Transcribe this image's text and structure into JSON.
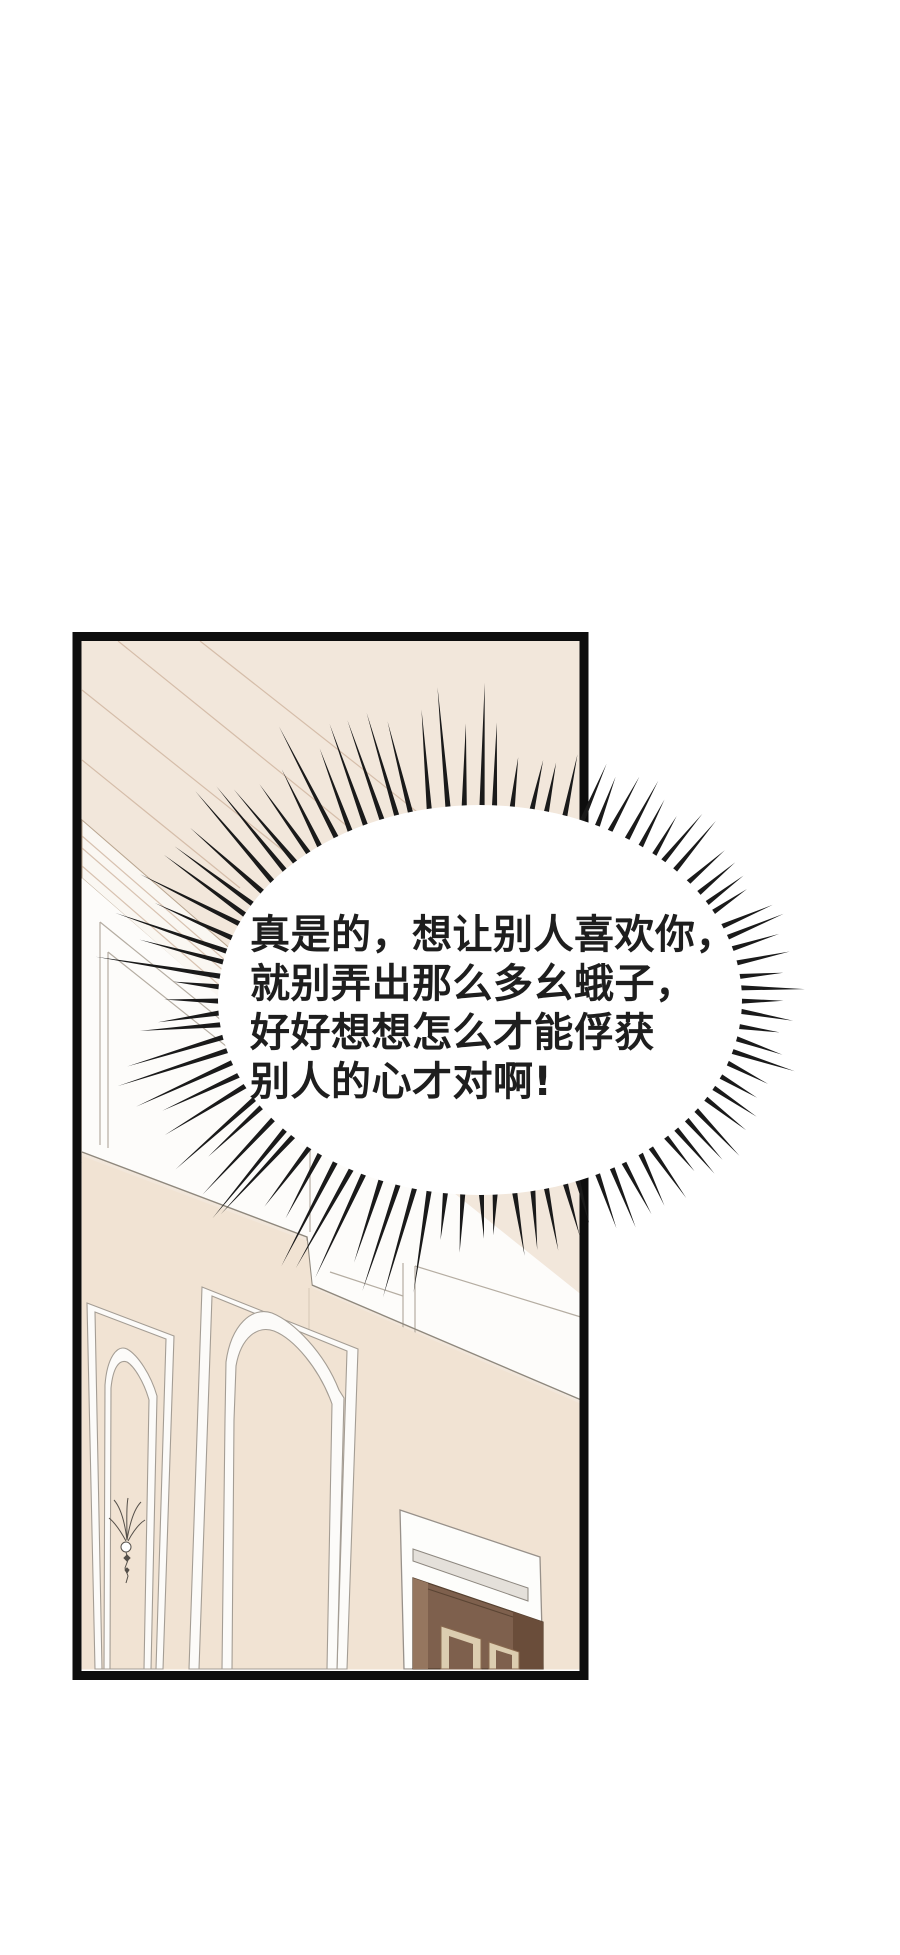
{
  "comic": {
    "panel_count": 1,
    "bubble": {
      "type": "burst-shout-bubble",
      "lines": [
        "真是的，想让别人喜欢你，",
        "就别弄出那么多幺蛾子，",
        "好好想想怎么才能俘获",
        "别人的心才对啊!"
      ]
    }
  },
  "colors": {
    "page_bg": "#ffffff",
    "panel_border": "#0d0d0d",
    "ceiling_beige": "#f2e7db",
    "lower_wall_beige": "#f1e3d3",
    "upper_wall_white": "#fdfcfa",
    "cornice_white": "#faf7f2",
    "door_brown": "#7e604d",
    "door_dark_stile": "#6a4d3a",
    "door_light_stile": "#95765f",
    "door_trim_cream": "#dccdb0",
    "lintel_gray": "#e4e0da",
    "bubble_fill": "#ffffff",
    "spike_color": "#1a1a1a",
    "text_color": "#1e1e1e"
  }
}
